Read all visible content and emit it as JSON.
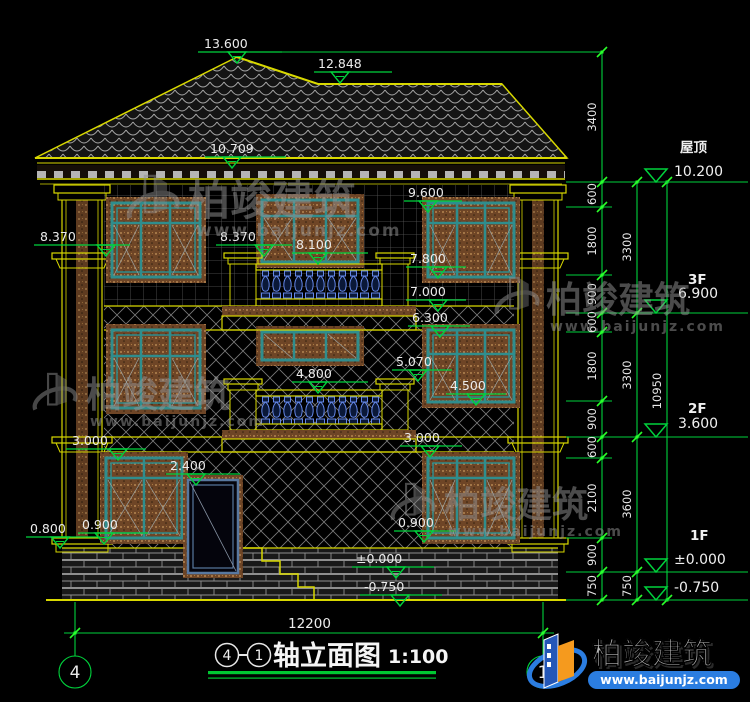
{
  "drawing": {
    "markers": [
      {
        "v": "13.600"
      },
      {
        "v": "12.848"
      },
      {
        "v": "10.709"
      },
      {
        "v": "9.600"
      },
      {
        "v": "8.370"
      },
      {
        "v": "8.370"
      },
      {
        "v": "8.100"
      },
      {
        "v": "7.800"
      },
      {
        "v": "7.000"
      },
      {
        "v": "6.300"
      },
      {
        "v": "5.070"
      },
      {
        "v": "4.800"
      },
      {
        "v": "4.500"
      },
      {
        "v": "3.000"
      },
      {
        "v": "3.000"
      },
      {
        "v": "2.400"
      },
      {
        "v": "0.900"
      },
      {
        "v": "0.800"
      },
      {
        "v": "0.900"
      },
      {
        "v": "±0.000"
      },
      {
        "v": "-0.750"
      }
    ],
    "levels": [
      {
        "name": "屋顶",
        "elev": "10.200"
      },
      {
        "name": "3F",
        "elev": "6.900"
      },
      {
        "name": "2F",
        "elev": "3.600"
      },
      {
        "name": "1F",
        "elev": "±0.000"
      },
      {
        "name": "",
        "elev": "-0.750"
      }
    ],
    "dims": {
      "c1": [
        "3400",
        "600",
        "1800",
        "900",
        "600",
        "1800",
        "900",
        "600",
        "2100",
        "900",
        "750"
      ],
      "c2": [
        "3300",
        "3300",
        "3600",
        "750"
      ],
      "c3": [
        "10950"
      ],
      "bottom": "12200"
    },
    "title": {
      "axis_start": "4",
      "axis_end": "1",
      "name": "轴立面图",
      "scale": "1:100"
    },
    "axis_bubbles": {
      "left": "4",
      "right": "1"
    },
    "watermark": {
      "brand": "柏竣建筑",
      "url": "www.baijunjz.com"
    },
    "logo": {
      "brand": "柏竣建筑",
      "url": "www.baijunjz.com"
    }
  }
}
